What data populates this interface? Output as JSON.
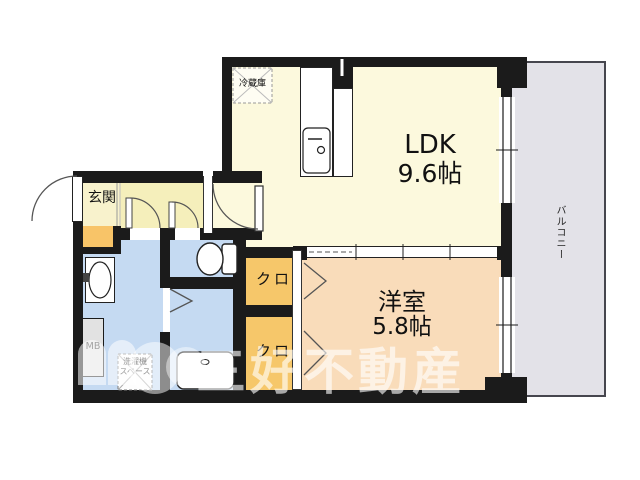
{
  "floorplan": {
    "rooms": {
      "ldk": {
        "name": "LDK",
        "size": "9.6帖"
      },
      "western": {
        "name": "洋室",
        "size": "5.8帖"
      },
      "entrance": {
        "label": "玄関"
      },
      "balcony": {
        "label": "バルコニー"
      },
      "closet_upper": {
        "label": "クロ"
      },
      "closet_lower": {
        "label": "クロ"
      }
    },
    "fixtures": {
      "refrigerator": {
        "label": "冷蔵庫"
      },
      "washer_space": {
        "line1": "洗濯機",
        "line2": "スペース"
      },
      "meter_box": {
        "label": "MB"
      }
    },
    "watermark": {
      "text": "三好不動産"
    },
    "colors": {
      "walls": "#1b1b1b",
      "ldk": "#fcf9dd",
      "hallway": "#f5efbb",
      "entrance": "#f8f2cc",
      "wet_rooms": "#c5daf2",
      "western_room": "#f9dcba",
      "closets": "#f6c76a",
      "shoe_cabinet": "#f8c468",
      "balcony": "#e3e2e8",
      "meter_box": "#e2e2e2"
    }
  }
}
